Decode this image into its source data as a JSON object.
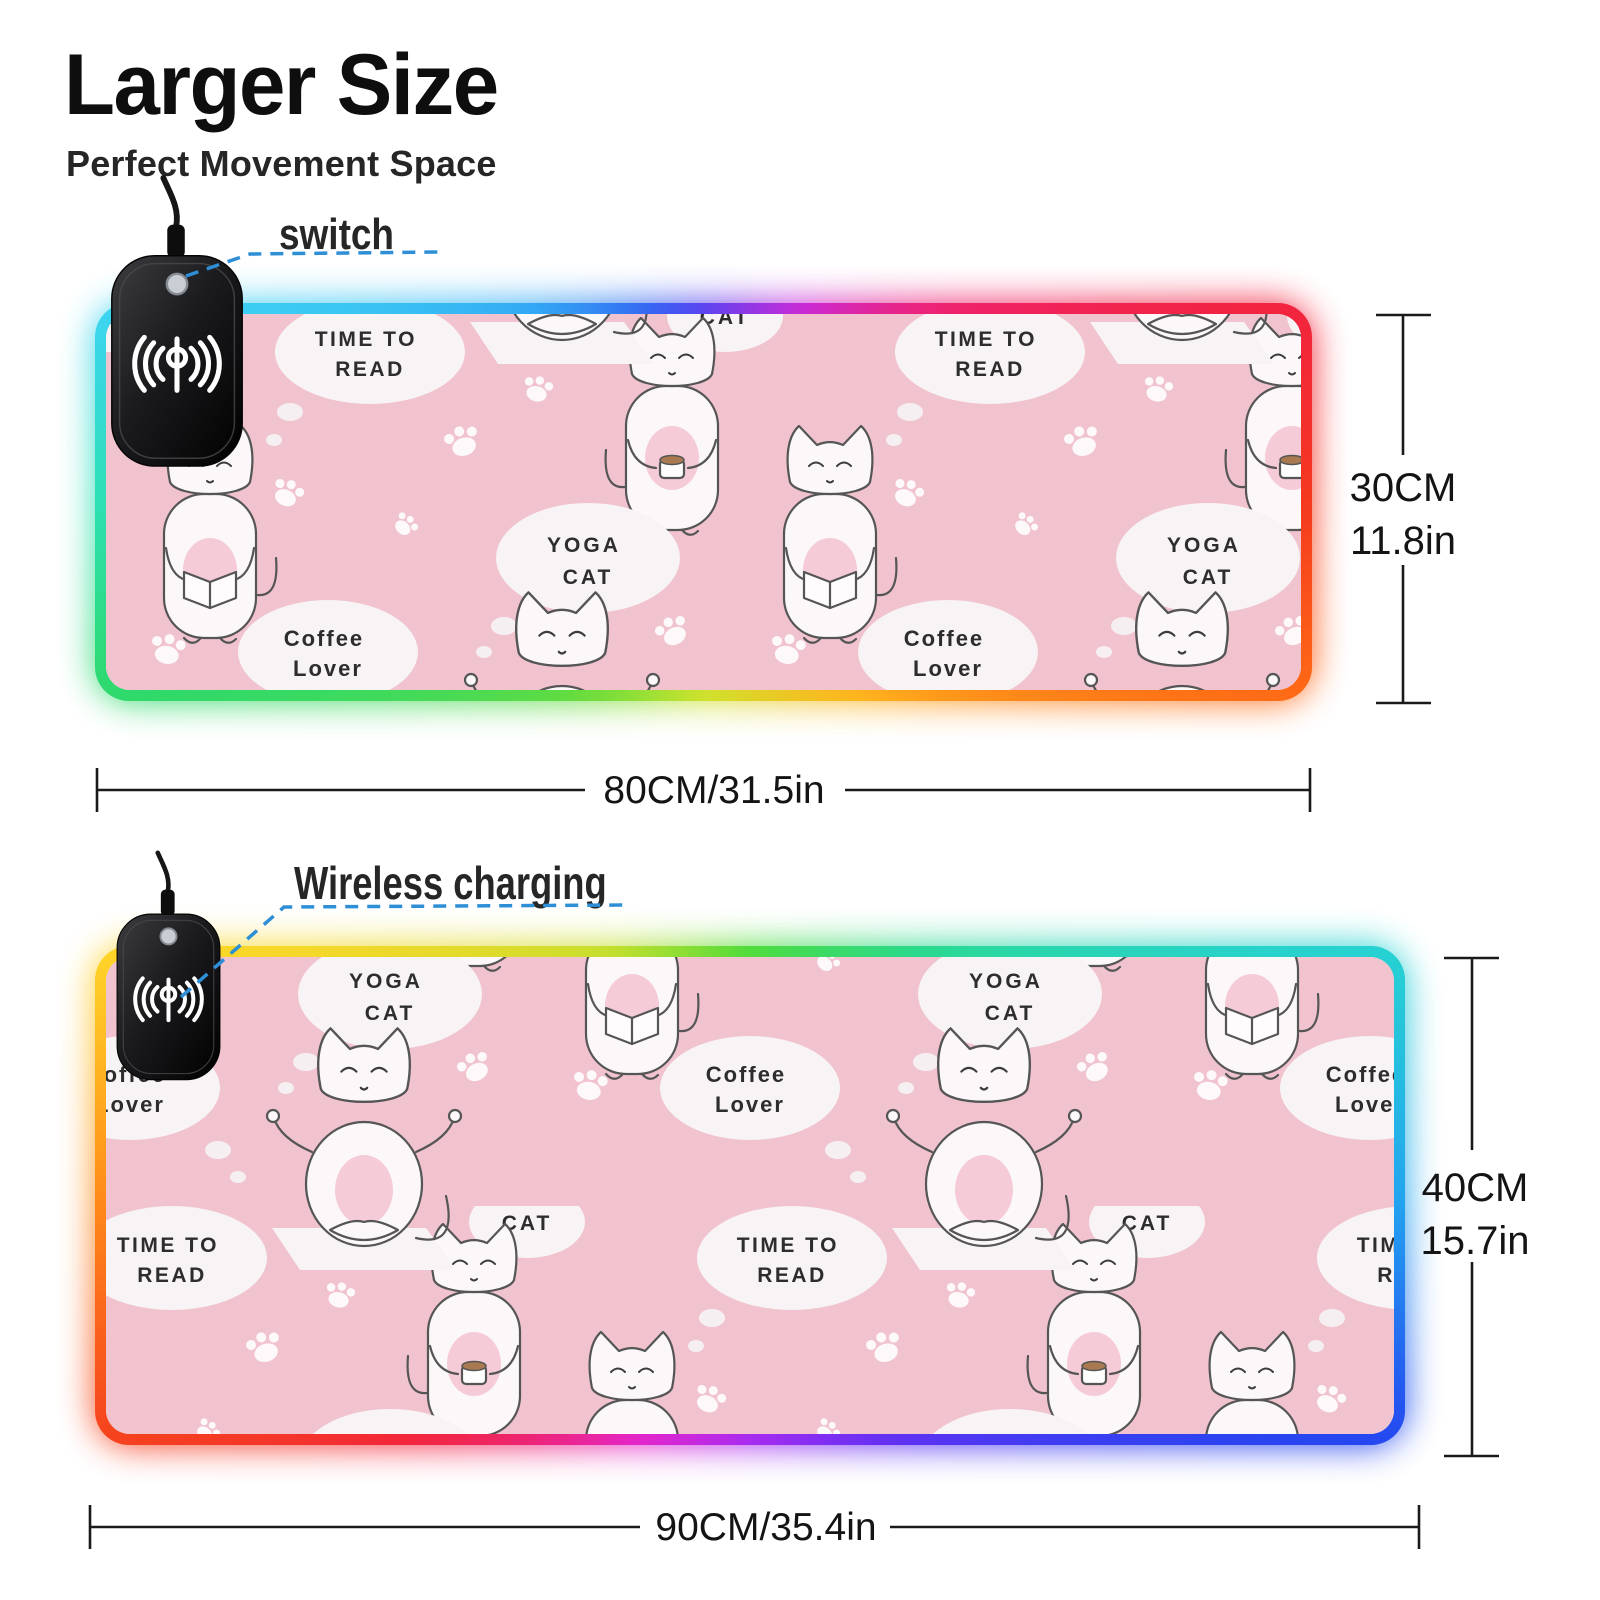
{
  "header": {
    "title": "Larger Size",
    "subtitle": "Perfect Movement Space"
  },
  "callouts": {
    "switch_label": "switch",
    "wireless_label": "Wireless charging"
  },
  "pad_small": {
    "height_cm": "30CM",
    "height_in": "11.8in",
    "width_label": "80CM/31.5in"
  },
  "pad_large": {
    "height_cm": "40CM",
    "height_in": "15.7in",
    "width_label": "90CM/35.4in"
  },
  "pattern_text": {
    "time_to_read_1": "TIME TO",
    "time_to_read_2": "READ",
    "yoga_cat_1": "YOGA",
    "yoga_cat_2": "CAT",
    "coffee_lover_1": "Coffee",
    "coffee_lover_2": "Lover",
    "cat": "CAT"
  },
  "icons": {
    "charger_icon": "wireless-charging-waves",
    "charger_button": "power-switch-button",
    "pattern_icons": [
      "cat-reading-book",
      "cat-holding-coffee",
      "yoga-cat-on-mat",
      "paw-print",
      "thought-bubble"
    ]
  },
  "colors": {
    "pad_pink": "#f0c3cf",
    "bubble_white": "#f8f3f4",
    "callout_blue": "#2e8fd6",
    "text_dark": "#111111",
    "charger_black": "#17171a",
    "rgb_small_pad": [
      "#3ed4f2",
      "#3566f2",
      "#cb2bd8",
      "#f2243f",
      "#ff6b16",
      "#cfe32e",
      "#2fd96b"
    ],
    "rgb_large_pad": [
      "#ffd629",
      "#4fdc3c",
      "#27d2d2",
      "#2547f0",
      "#a82cf0",
      "#f2263c",
      "#ff8c1a"
    ]
  }
}
